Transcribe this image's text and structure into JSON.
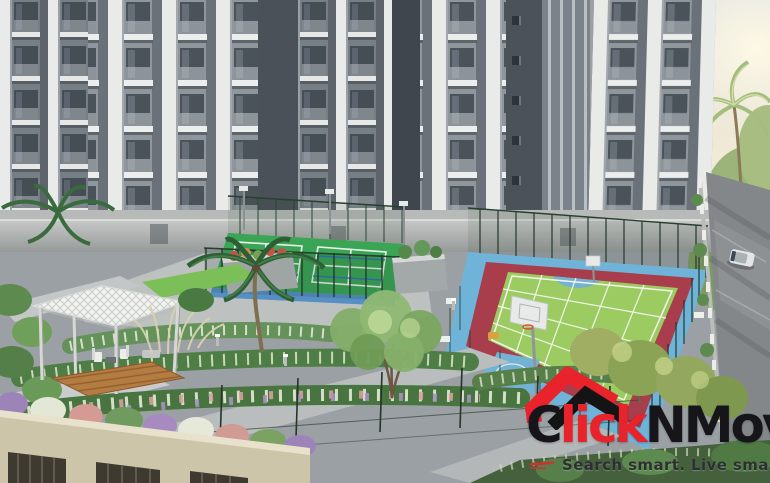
{
  "branding": {
    "logo": {
      "part1": "C",
      "part2": "lick",
      "part3": "NMove",
      "accent_color": "#e8232b",
      "dark_color": "#15151a"
    },
    "tagline": {
      "text": "Search smart. Live smarter",
      "color": "#2e2f33"
    }
  },
  "scene": {
    "type": "3d-architectural-render",
    "setting": "Aerial view of a residential complex: grey apartment towers with white balconies above a podium with two green tennis courts, a large multi-sport court with red and blue borders, a white gazebo with wooden deck, landscaped flower beds, palm trees and an access road with a car",
    "palette": {
      "facade_grey": "#767e86",
      "balcony_white": "#e9ebea",
      "court_green": "#2ea04a",
      "multicourt_green": "#9ccb62",
      "court_red_band": "#a83d4b",
      "court_blue_band": "#6fb3d8",
      "podium_beige": "#cdc5a9",
      "road_grey": "#83878a",
      "sky_warm": "#f6eed3"
    }
  }
}
